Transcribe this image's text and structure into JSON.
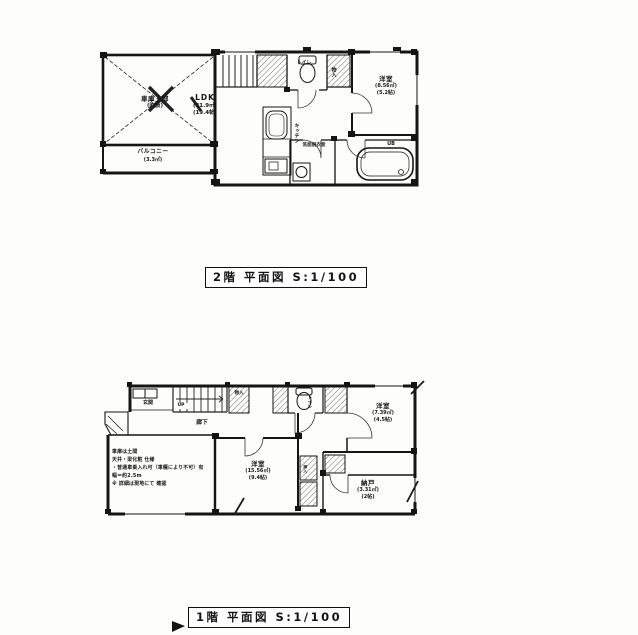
{
  "floor2": {
    "caption": "2階 平面図 S:1/100",
    "rooms": {
      "void": {
        "name": "車庫上部",
        "note": "(吹抜)"
      },
      "balcony": {
        "name": "バルコニー",
        "area_sqm": "(3.3㎡)"
      },
      "ldk": {
        "name": "LDK",
        "area_sqm": "(31.9㎡)",
        "area_jo": "(19.4帖)"
      },
      "toilet": {
        "name": "トイレ"
      },
      "closet": {
        "name": "物入"
      },
      "bedroom": {
        "name": "洋室",
        "area_sqm": "(8.56㎡)",
        "area_jo": "(5.2帖)"
      },
      "kitchen": {
        "name": "キッチン"
      },
      "washroom": {
        "name": "洗面脱衣室"
      },
      "bath": {
        "name": "UB"
      }
    }
  },
  "floor1": {
    "caption": "1階 平面図 S:1/100",
    "rooms": {
      "entrance": {
        "name": "玄関"
      },
      "hallway": {
        "name": "廊下"
      },
      "stairs": {
        "name": "UP"
      },
      "closet_a": {
        "name": "物入"
      },
      "toilet": {
        "name": "トイレ"
      },
      "bedroom_b": {
        "name": "洋室",
        "area_sqm": "(7.39㎡)",
        "area_jo": "(4.5帖)"
      },
      "bedroom_a": {
        "name": "洋室",
        "area_sqm": "(15.56㎡)",
        "area_jo": "(9.4帖)"
      },
      "storage": {
        "name": "納戸",
        "area_sqm": "(3.31㎡)",
        "area_jo": "(2帖)"
      },
      "closet_b": {
        "name": "押入"
      },
      "garage_notes": {
        "line1": "車庫は土間",
        "line2": "天井・梁化粧 仕様",
        "line3": "・普通車乗入れ可（車種により不可）有",
        "line4": "幅＝約2.5m",
        "line5": "※ 詳細は現地にて 確認"
      }
    }
  }
}
